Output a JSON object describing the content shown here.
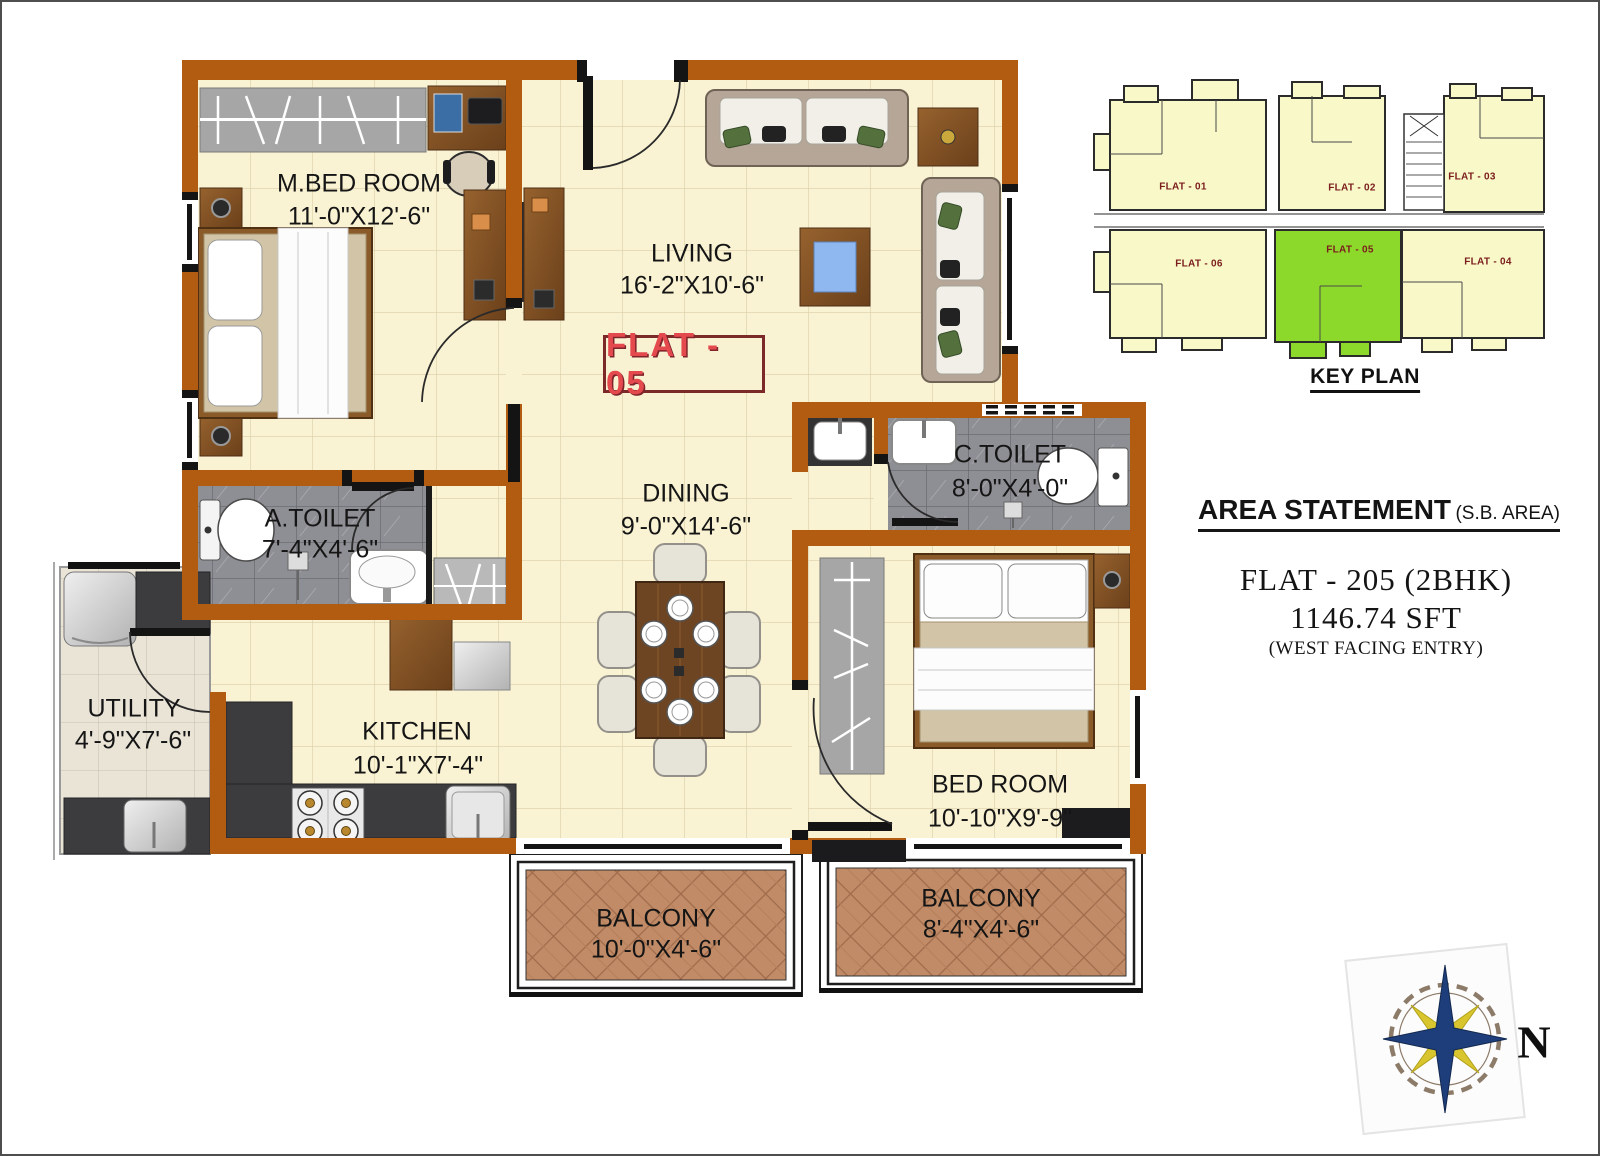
{
  "plan": {
    "flat_badge": "FLAT - 05",
    "rooms": [
      {
        "name": "M.BED ROOM",
        "dim": "11'-0\"X12'-6\""
      },
      {
        "name": "LIVING",
        "dim": "16'-2\"X10'-6\""
      },
      {
        "name": "DINING",
        "dim": "9'-0\"X14'-6\""
      },
      {
        "name": "A.TOILET",
        "dim": "7'-4\"X4'-6\""
      },
      {
        "name": "C.TOILET",
        "dim": "8'-0\"X4'-0\""
      },
      {
        "name": "KITCHEN",
        "dim": "10'-1\"X7'-4\""
      },
      {
        "name": "UTILITY",
        "dim": "4'-9\"X7'-6\""
      },
      {
        "name": "BED ROOM",
        "dim": "10'-10\"X9'-9\""
      },
      {
        "name": "BALCONY",
        "dim": "10'-0\"X4'-6\""
      },
      {
        "name": "BALCONY",
        "dim": "8'-4\"X4'-6\""
      }
    ]
  },
  "key_plan": {
    "title": "KEY PLAN",
    "flats": [
      {
        "label": "FLAT - 01"
      },
      {
        "label": "FLAT - 02"
      },
      {
        "label": "FLAT - 03"
      },
      {
        "label": "FLAT - 06"
      },
      {
        "label": "FLAT - 05"
      },
      {
        "label": "FLAT - 04"
      }
    ],
    "highlighted": "FLAT - 05"
  },
  "area_statement": {
    "title": "AREA STATEMENT",
    "qualifier": "(S.B. AREA)",
    "flat": "FLAT - 205 (2BHK)",
    "area": "1146.74 SFT",
    "facing": "(WEST FACING ENTRY)"
  },
  "compass": {
    "north": "N"
  },
  "colors": {
    "wall": "#b25c12",
    "floor": "#f9f2d3",
    "keyplan_yellow": "#f8f8c9",
    "highlight_green": "#8dd92b",
    "badge_red": "#e4494e",
    "label_maroon": "#7b1d1d"
  }
}
